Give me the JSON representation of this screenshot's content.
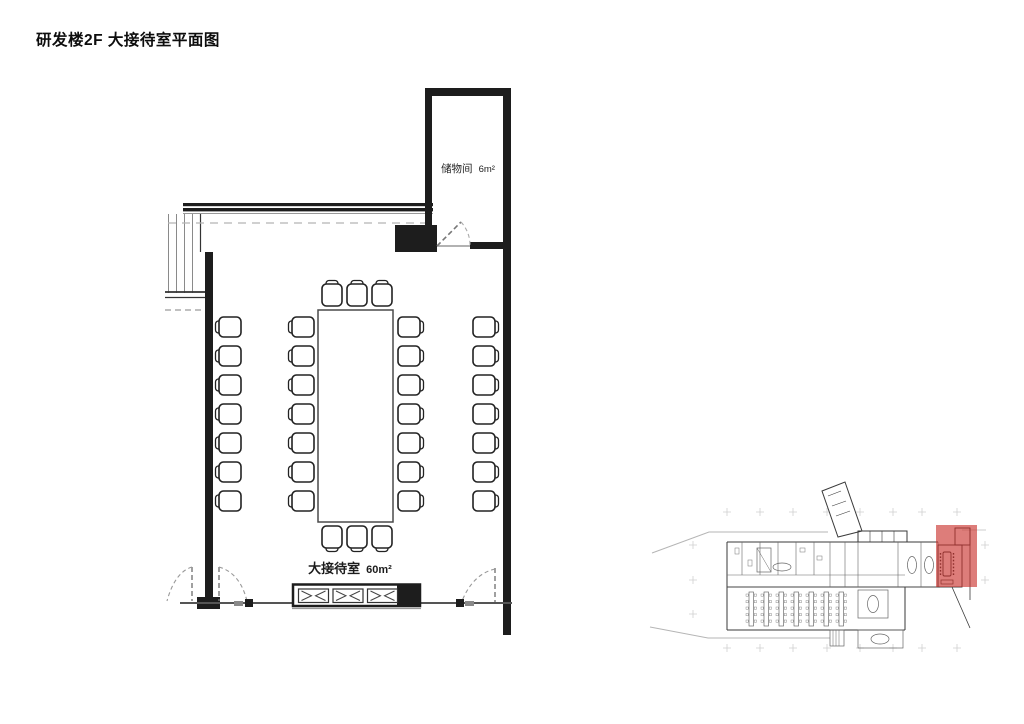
{
  "page": {
    "title": "研发楼2F 大接待室平面图"
  },
  "rooms": {
    "reception": {
      "label": "大接待室",
      "area": "60m²"
    },
    "storage": {
      "label": "储物间",
      "area": "6m²"
    }
  },
  "furniture": {
    "conference_table_chairs": {
      "left": 7,
      "right": 7,
      "top": 3,
      "bottom": 3
    },
    "wall_chairs": {
      "left": 7,
      "right": 7
    },
    "sideboard_sections": 3
  },
  "inset": {
    "desk_rows": 7
  },
  "colors": {
    "wall": "#1d1d1d",
    "thin_line": "#4a4a4a",
    "guide_line": "#9b9b9b",
    "highlight": "rgba(200,45,40,0.62)"
  }
}
